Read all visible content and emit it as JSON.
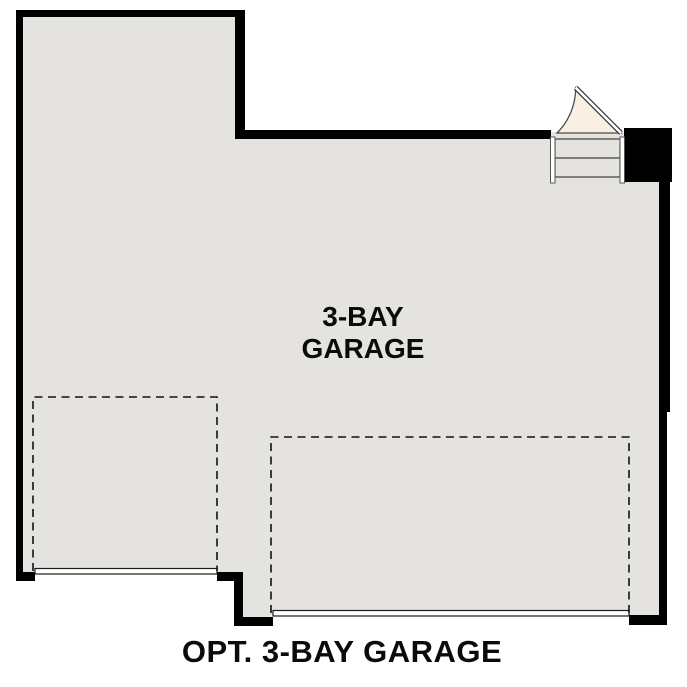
{
  "plan": {
    "room": {
      "label_line1": "3-BAY",
      "label_line2": "GARAGE"
    },
    "caption": "OPT. 3-BAY GARAGE",
    "icons": {
      "door": "entry-door-swing-icon",
      "steps": "entry-steps-icon"
    }
  },
  "colors": {
    "background": "#ffffff",
    "wall": "#000000",
    "floor": "#e5e3e0",
    "door_swing_fill": "#f8f0e2",
    "detail_stroke": "#3d3d3d",
    "text": "#0b0b0b"
  }
}
